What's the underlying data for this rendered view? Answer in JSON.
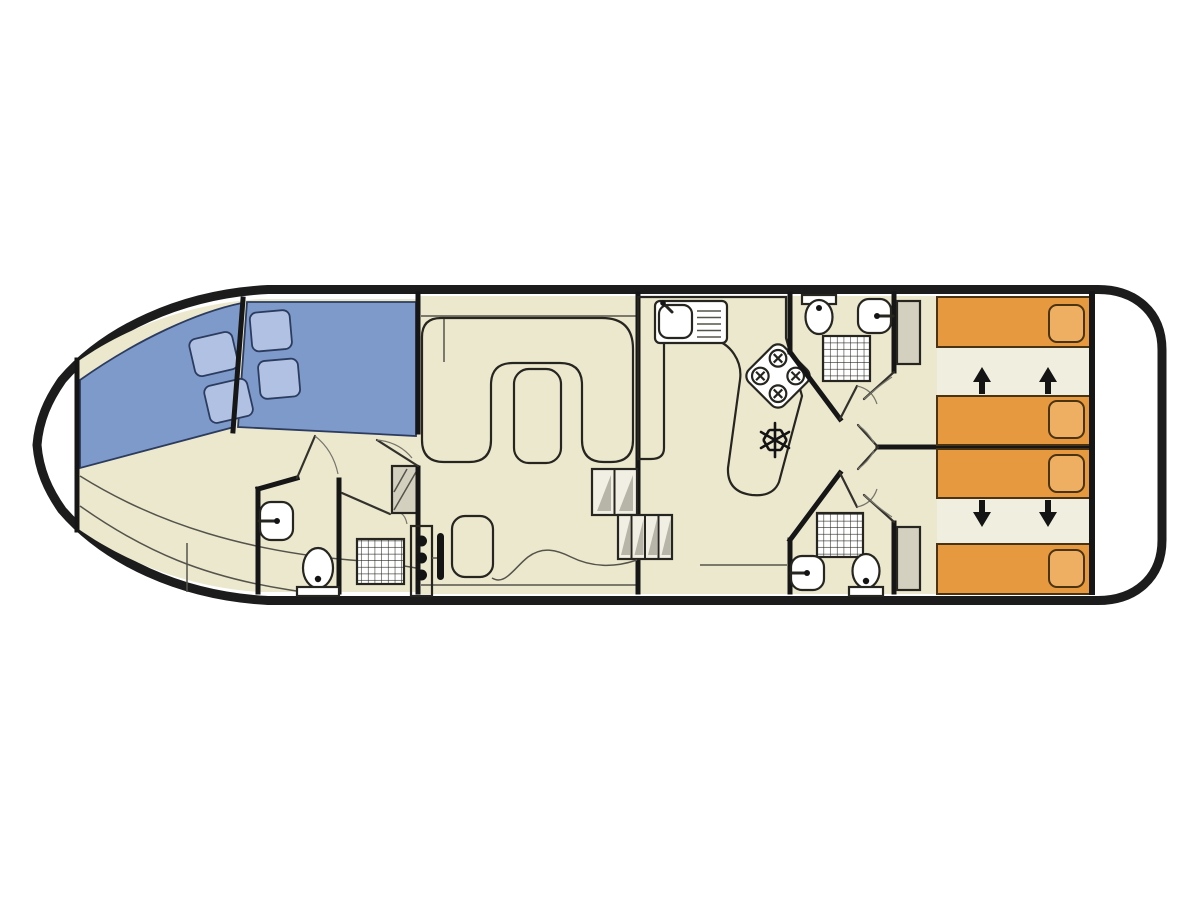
{
  "plan": {
    "kind": "boat-floor-plan",
    "orientation": "bow-left-stern-right",
    "areas": {
      "bow_deck": "open white bow tip",
      "bow_cabin": {
        "berths": 2,
        "pillows": 4,
        "bench": "curved bench along port side"
      },
      "bow_bathroom": {
        "fixtures": [
          "washbasin",
          "toilet",
          "shower"
        ]
      },
      "lobby": {
        "fixtures": [
          "wardrobe"
        ]
      },
      "saloon": {
        "sofa": "U-shaped dinette",
        "table": 1,
        "helm": {
          "knobs": 3,
          "wheel": 1,
          "seat": 1
        },
        "steps": [
          "2-step",
          "4-step"
        ]
      },
      "galley": {
        "fixtures": [
          "sink-with-drainer",
          "hob-4-burner",
          "refrigerator"
        ]
      },
      "bathroom_top": {
        "fixtures": [
          "toilet",
          "washbasin",
          "shower",
          "wardrobe"
        ]
      },
      "bathroom_bottom": {
        "fixtures": [
          "washbasin",
          "toilet",
          "shower",
          "wardrobe"
        ]
      },
      "aft_cabin_top": {
        "beds": 2,
        "slide_arrows": "up"
      },
      "aft_cabin_bottom": {
        "beds": 2,
        "slide_arrows": "down"
      },
      "stern_deck": "open white stern platform"
    }
  },
  "colors": {
    "white": "#ffffff",
    "ink": "#141414",
    "floor": "#ece8ce",
    "floor_light": "#f0eedf",
    "counter": "#d8d5c3",
    "table": "#dedbc7",
    "sofa": "#7ec5ae",
    "bed_blue": "#7e9acb",
    "pillow_blue": "#b0c1e3",
    "bed_orange": "#e7993f",
    "pillow_orange": "#efaf63",
    "seat_pink": "#e9ccd3",
    "wardrobe": "#d3d0bf",
    "step_face": "#f1efe3",
    "step_shade": "#b7b5a8"
  }
}
